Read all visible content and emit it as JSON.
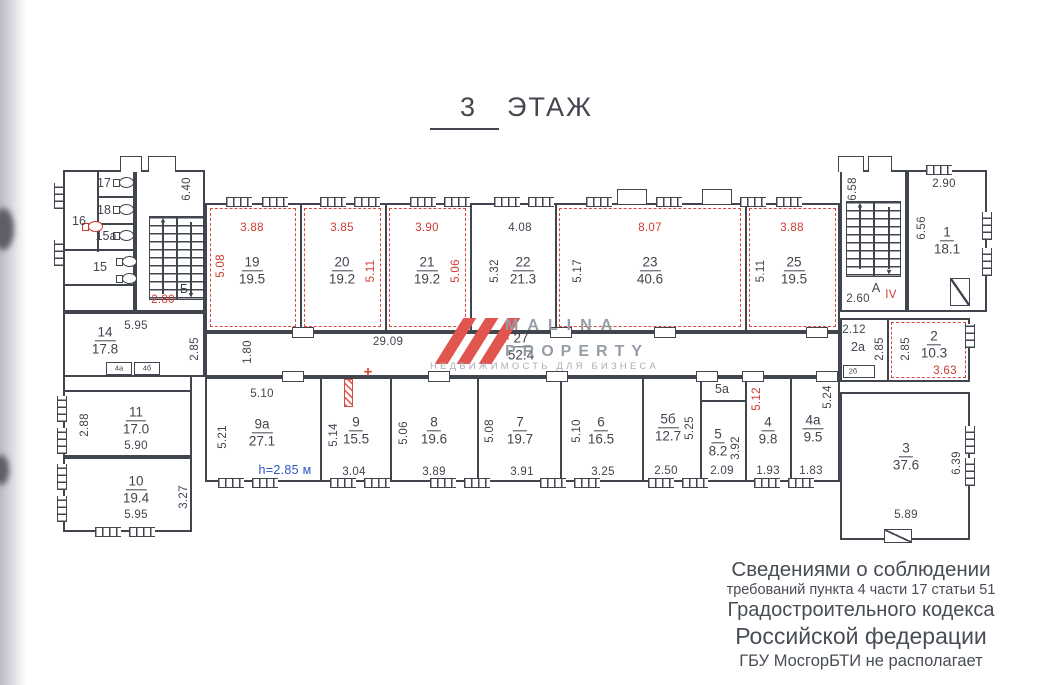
{
  "title": {
    "num": "3",
    "word": "ЭТАЖ"
  },
  "stairwells": {
    "b": {
      "label": "Б",
      "dim_height": "6.40",
      "dim_red": "2.80"
    },
    "a": {
      "label": "А",
      "dim_height": "6.58",
      "dim_width": "2.60",
      "section": "IV"
    }
  },
  "rooms": {
    "r1": {
      "num": "1",
      "area": "18.1",
      "dim_top": "2.90",
      "dim_left": "6.56"
    },
    "r2": {
      "num": "2",
      "area": "10.3",
      "dim_left": "2.85",
      "dim_bottom": "3.63"
    },
    "r2a": {
      "num": "2а",
      "dim_top": "2.12",
      "dim_right": "2.85"
    },
    "r3": {
      "num": "3",
      "area": "37.6",
      "dim_right": "6.39",
      "dim_bottom": "5.89"
    },
    "r4": {
      "num": "4",
      "area": "9.8",
      "dim_left": "5.12",
      "dim_bottom": "1.93"
    },
    "r4a": {
      "num": "4а",
      "area": "9.5",
      "dim_right": "5.24",
      "dim_bottom": "1.83"
    },
    "r5": {
      "num": "5",
      "area": "8.2",
      "dim_right": "3.92",
      "dim_bottom": "2.09"
    },
    "r5a": {
      "num": "5а"
    },
    "r5b": {
      "num": "5б",
      "area": "12.7",
      "dim_right": "5.25",
      "dim_bottom": "2.50"
    },
    "r6": {
      "num": "6",
      "area": "16.5",
      "dim_left": "5.10",
      "dim_bottom": "3.25"
    },
    "r7": {
      "num": "7",
      "area": "19.7",
      "dim_left": "5.08",
      "dim_bottom": "3.91"
    },
    "r8": {
      "num": "8",
      "area": "19.6",
      "dim_left": "5.06",
      "dim_bottom": "3.89"
    },
    "r9": {
      "num": "9",
      "area": "15.5",
      "dim_left": "5.14",
      "dim_bottom": "3.04"
    },
    "r9a": {
      "num": "9а",
      "area": "27.1",
      "dim_top": "5.10",
      "dim_left": "5.21"
    },
    "r10": {
      "num": "10",
      "area": "19.4",
      "dim_right": "3.27",
      "dim_bottom": "5.95"
    },
    "r11": {
      "num": "11",
      "area": "17.0",
      "dim_left": "2.88",
      "dim_bottom": "5.90"
    },
    "r14": {
      "num": "14",
      "area": "17.8",
      "dim_top": "5.95",
      "dim_right": "2.85"
    },
    "r15": {
      "num": "15"
    },
    "r15a": {
      "num": "15а"
    },
    "r16": {
      "num": "16"
    },
    "r17": {
      "num": "17"
    },
    "r18": {
      "num": "18"
    },
    "r19": {
      "num": "19",
      "area": "19.5",
      "dim_top": "3.88",
      "dim_left": "5.08"
    },
    "r20": {
      "num": "20",
      "area": "19.2",
      "dim_top": "3.85",
      "dim_right": "5.11"
    },
    "r21": {
      "num": "21",
      "area": "19.2",
      "dim_top": "3.90",
      "dim_right": "5.06"
    },
    "r22": {
      "num": "22",
      "area": "21.3",
      "dim_top": "4.08",
      "dim_left": "5.32"
    },
    "r23": {
      "num": "23",
      "area": "40.6",
      "dim_top": "8.07",
      "dim_left": "5.17"
    },
    "r25": {
      "num": "25",
      "area": "19.5",
      "dim_top": "3.88",
      "dim_left": "5.11"
    },
    "r27": {
      "num": "27",
      "area": "52.4",
      "dim_length": "29.09",
      "dim_width": "1.80"
    }
  },
  "closets": {
    "c1": "4а",
    "c2": "4б",
    "c3": "2б"
  },
  "notes": {
    "ceiling_height": "h=2.85 м"
  },
  "watermark": {
    "line1": "MALINA",
    "line2": "PROPERTY",
    "line3": "НЕДВИЖИМОСТЬ ДЛЯ БИЗНЕСА"
  },
  "disclaimer": {
    "line1": "Сведениями о соблюдении",
    "line2": "требований пункта 4 части 17 статьи 51",
    "line3": "Градостроительного кодекса",
    "line4": "Российской федерации",
    "line5": "ГБУ МосгорБТИ не располагает"
  },
  "colors": {
    "red": "#cf3a30",
    "blue": "#2d55c4",
    "ink": "#41454d"
  }
}
